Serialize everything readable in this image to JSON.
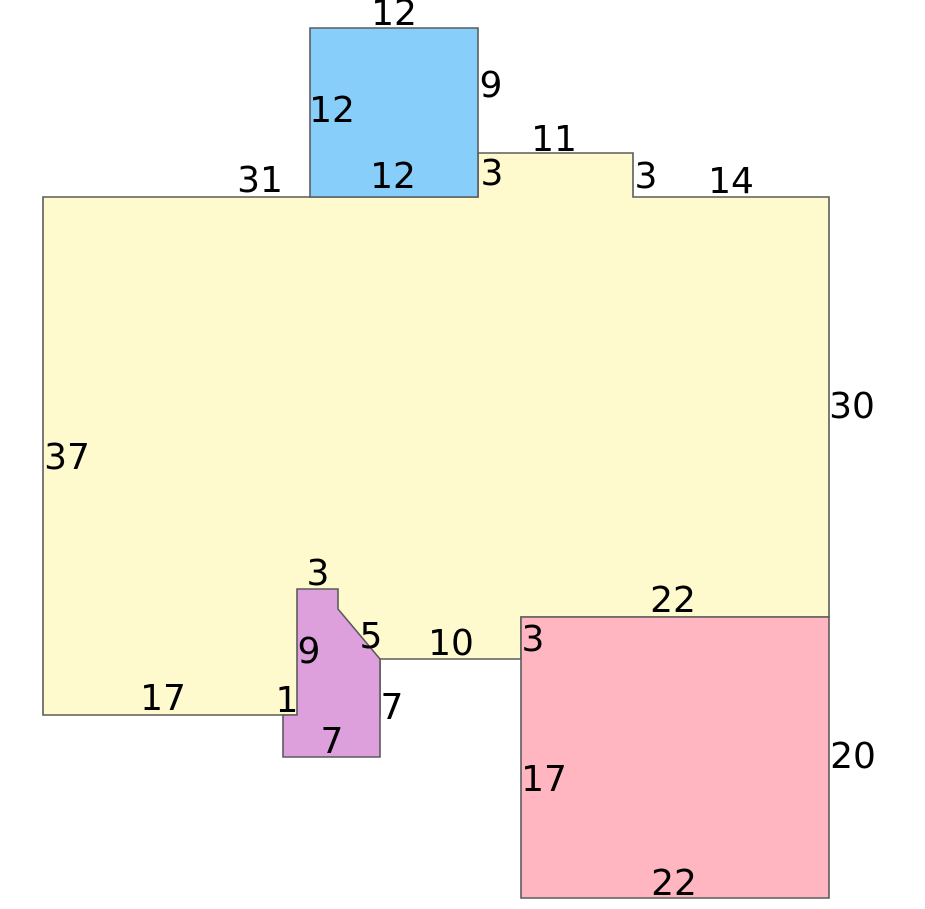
{
  "figure": {
    "background": "#ffffff",
    "stroke_color": "#5a5a5a",
    "stroke_width": 1.6,
    "text_color": "#000000",
    "font_size": 36
  },
  "shapes": {
    "blue_square": {
      "fill": "#87CEFA",
      "points": "310,28 478,28 478,197 310,197",
      "labels": [
        {
          "text": "12",
          "x": 394,
          "y": 25,
          "edge": "top-outside"
        },
        {
          "text": "9",
          "x": 491,
          "y": 97,
          "edge": "right-outside"
        },
        {
          "text": "12",
          "x": 332,
          "y": 122,
          "edge": "left-inside"
        },
        {
          "text": "12",
          "x": 393,
          "y": 188,
          "edge": "bottom-inside"
        }
      ]
    },
    "yellow_polygon": {
      "fill": "#FFFACD",
      "points": "43,197 478,197 478,153 633,153 633,197 829,197 829,617 521,617 521,659 380,659 380,715 43,715",
      "labels": [
        {
          "text": "31",
          "x": 260,
          "y": 192,
          "edge": "top-left-outside"
        },
        {
          "text": "3",
          "x": 492,
          "y": 185,
          "edge": "notch-left-inside"
        },
        {
          "text": "11",
          "x": 554,
          "y": 151,
          "edge": "notch-top-outside"
        },
        {
          "text": "3",
          "x": 646,
          "y": 188,
          "edge": "notch-right-outside"
        },
        {
          "text": "14",
          "x": 731,
          "y": 193,
          "edge": "top-right-outside"
        },
        {
          "text": "30",
          "x": 852,
          "y": 418,
          "edge": "right-outside"
        },
        {
          "text": "37",
          "x": 67,
          "y": 469,
          "edge": "left-inside"
        },
        {
          "text": "17",
          "x": 163,
          "y": 710,
          "edge": "bottom-left-inside"
        },
        {
          "text": "10",
          "x": 451,
          "y": 655,
          "edge": "bottom-middle-inside"
        },
        {
          "text": "22",
          "x": 673,
          "y": 612,
          "edge": "bottom-right-inside"
        },
        {
          "text": "3",
          "x": 533,
          "y": 651,
          "edge": "step-down-right"
        }
      ]
    },
    "purple_polygon": {
      "fill": "#DDA0DD",
      "points": "297,589 338,589 338,609 380,659 380,757 283,757 283,715 297,715",
      "labels": [
        {
          "text": "3",
          "x": 318,
          "y": 585,
          "edge": "top-outside"
        },
        {
          "text": "5",
          "x": 371,
          "y": 648,
          "edge": "diagonal-outside"
        },
        {
          "text": "9",
          "x": 309,
          "y": 663,
          "edge": "left-inside"
        },
        {
          "text": "1",
          "x": 287,
          "y": 712,
          "edge": "left-step"
        },
        {
          "text": "7",
          "x": 392,
          "y": 719,
          "edge": "right-outside"
        },
        {
          "text": "7",
          "x": 332,
          "y": 753,
          "edge": "bottom-inside"
        }
      ]
    },
    "pink_rectangle": {
      "fill": "#FFB6C1",
      "points": "521,617 829,617 829,898 521,898",
      "labels": [
        {
          "text": "17",
          "x": 544,
          "y": 791,
          "edge": "left-inside"
        },
        {
          "text": "20",
          "x": 853,
          "y": 768,
          "edge": "right-outside"
        },
        {
          "text": "22",
          "x": 674,
          "y": 895,
          "edge": "bottom-inside"
        }
      ]
    }
  }
}
